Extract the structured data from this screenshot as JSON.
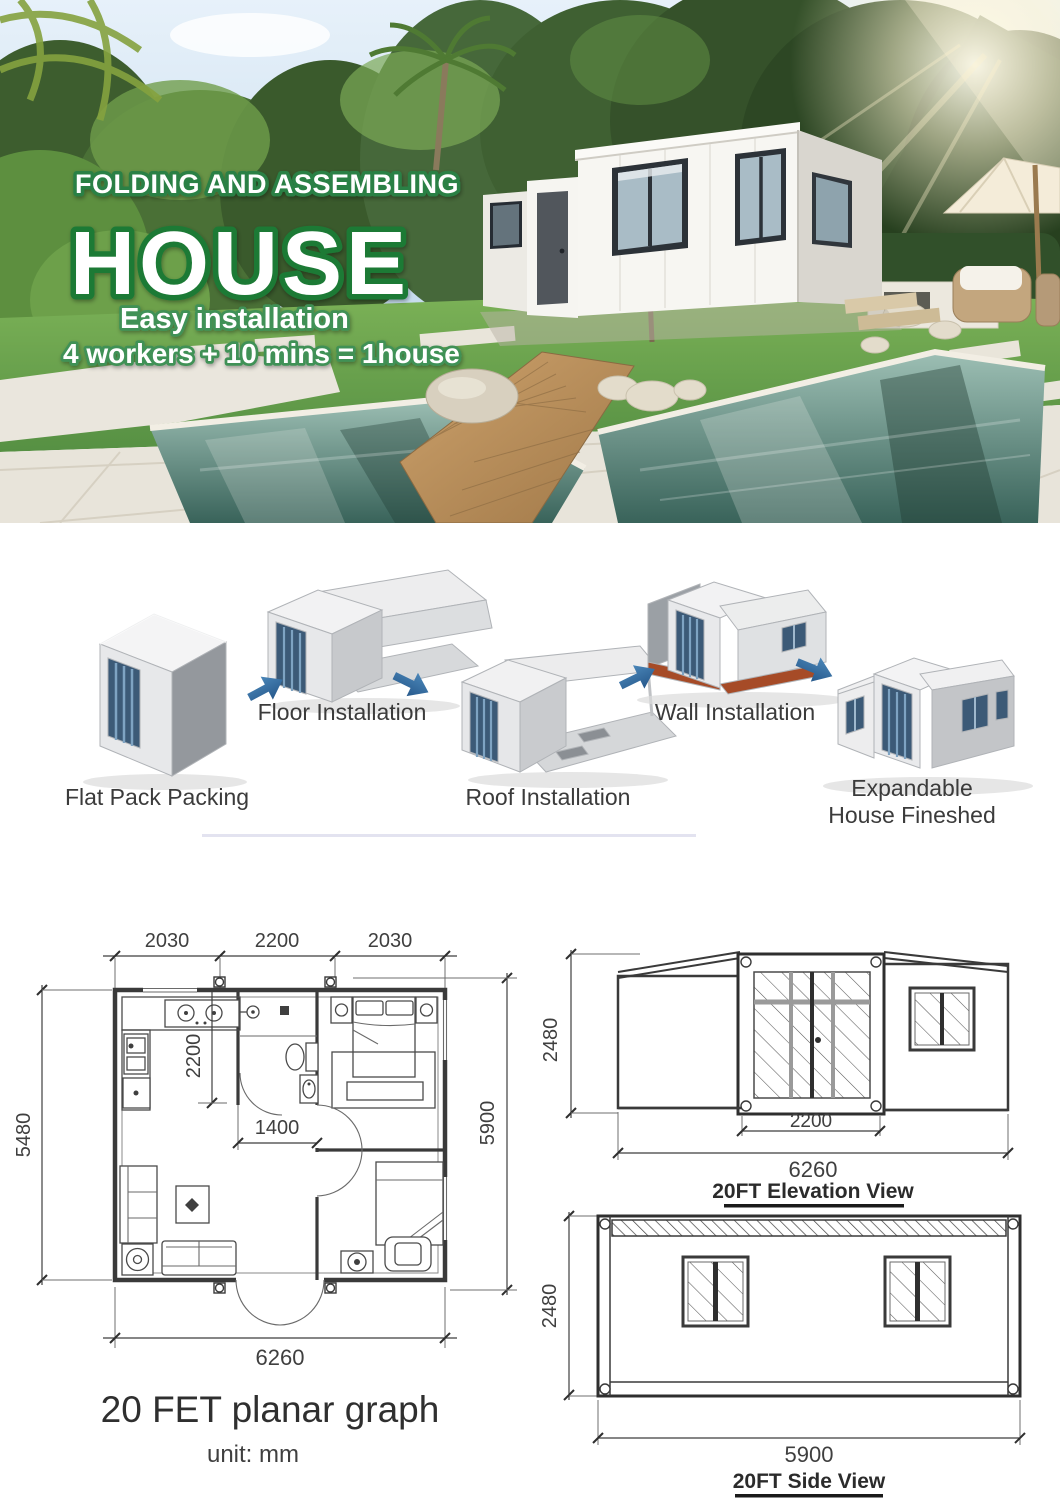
{
  "hero": {
    "title_line1": "FOLDING AND ASSEMBLING",
    "title_line2": "HOUSE",
    "subtitle": "Easy installation",
    "tagline": "4 workers + 10 mins = 1house",
    "outline_green": "#2a8045",
    "outline_dark_green": "#1d7a36"
  },
  "assembly": {
    "arrow_color": "#2f6da8",
    "steps": [
      {
        "label": "Flat Pack Packing"
      },
      {
        "label": "Floor Installation"
      },
      {
        "label": "Roof Installation"
      },
      {
        "label": "Wall Installation"
      },
      {
        "label": "Expandable",
        "label_line2": "House Fineshed"
      }
    ]
  },
  "drawings": {
    "line_color": "#3f3f3f",
    "floor_plan": {
      "title": "20 FET planar graph",
      "unit_note": "unit: mm",
      "dim_top_left": "2030",
      "dim_top_center": "2200",
      "dim_top_right": "2030",
      "dim_left_height": "5480",
      "dim_right_height": "5900",
      "dim_kitchen_depth": "2200",
      "dim_hall_width": "1400",
      "dim_bottom_width": "6260"
    },
    "elevation_view": {
      "title": "20FT Elevation View",
      "dim_height": "2480",
      "dim_door_width": "2200",
      "dim_total_width": "6260"
    },
    "side_view": {
      "title": "20FT Side View",
      "dim_height": "2480",
      "dim_width": "5900"
    }
  }
}
